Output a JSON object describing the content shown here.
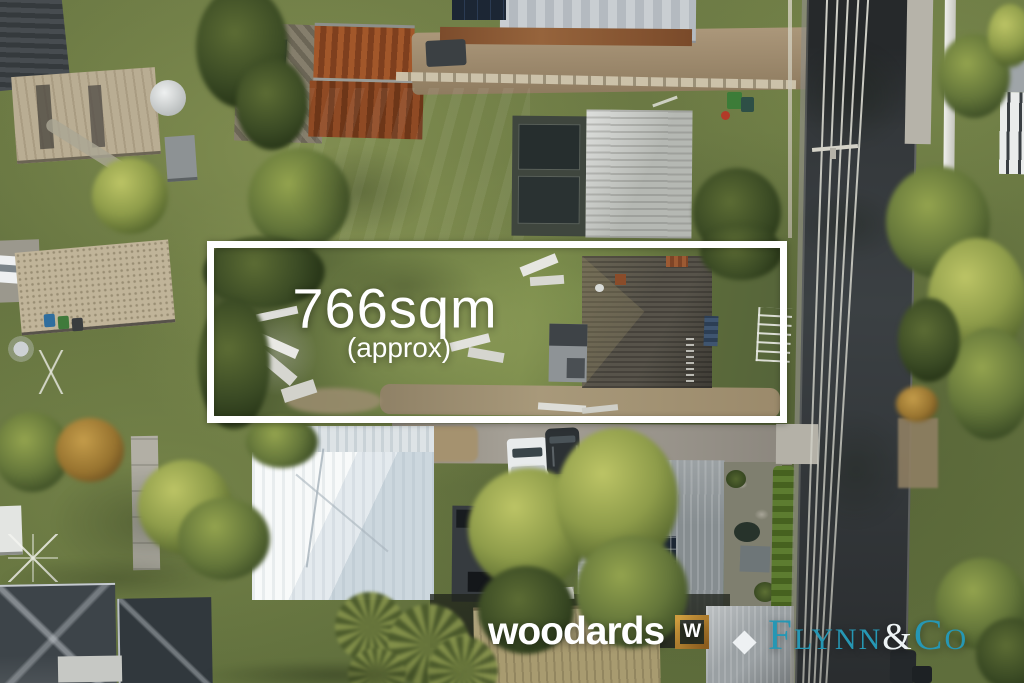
{
  "image": {
    "type": "aerial-property-photo",
    "description": "Drone aerial view of a residential block for sale with white marked boundary"
  },
  "overlay": {
    "boundary_color": "#ffffff",
    "area_label": "766sqm",
    "area_qualifier": "(approx)",
    "text_color": "#ffffff"
  },
  "branding": {
    "woodards": {
      "wordmark": "woodards",
      "monogram": "W",
      "wordmark_color": "#ffffff",
      "monogram_frame_color": "#b07f2e"
    },
    "flynn_co": {
      "part1_initial": "F",
      "part1_rest": "LYNN",
      "ampersand": "&",
      "part2_initial": "C",
      "part2_rest": "O",
      "brand_color": "#2697b4",
      "ampersand_color": "#eef4f5"
    }
  },
  "scene_palette": {
    "grass_sunlit": "#8a9853",
    "grass_shadow": "#46522c",
    "road_asphalt": "#323639",
    "dirt": "#a08b6c",
    "roof_white": "#edf0f2",
    "roof_dark_grey": "#40464b",
    "roof_rust": "#94502a",
    "roof_tan": "#a89b70",
    "tree_canopy": "#a3ad52",
    "concrete": "#b4b1a7"
  }
}
